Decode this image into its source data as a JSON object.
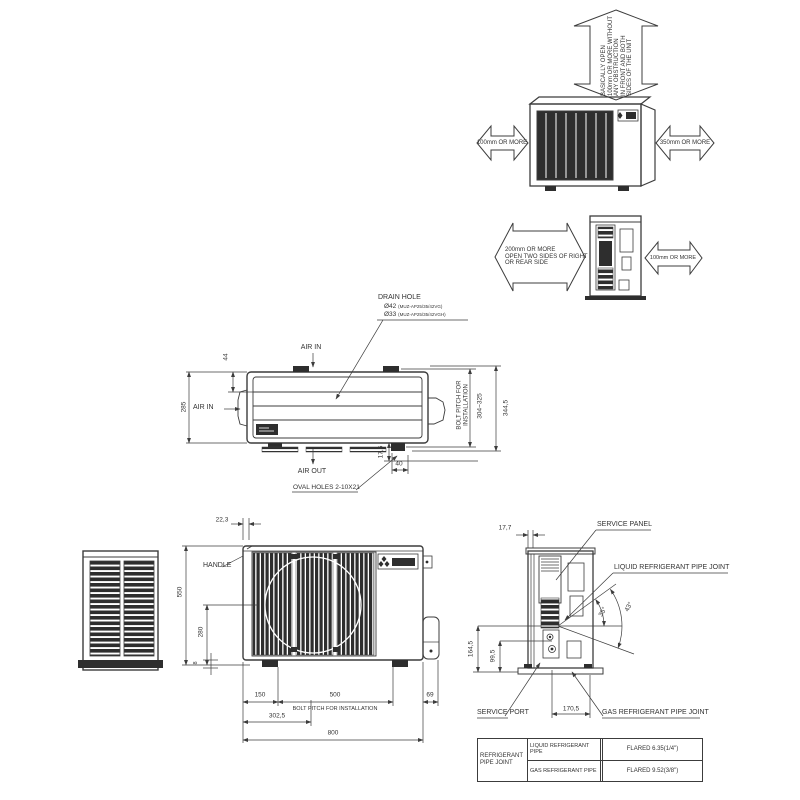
{
  "drawing_type": "outdoor-unit-dimension-drawing",
  "colors": {
    "line": "#3c3c3c",
    "dark_fill": "#2e2e2e",
    "text": "#333333",
    "background": "#ffffff"
  },
  "clearance_front": {
    "vertical_l1": "BASICALLY OPEN",
    "vertical_l2": "100mm OR MORE WITHOUT",
    "vertical_l3": "ANY OBSTRUCTION",
    "vertical_l4": "IN FRONT AND BOTH",
    "vertical_l5": "SIDES OF THE UNIT",
    "left_label": "100mm OR MORE",
    "right_label": "350mm OR MORE"
  },
  "clearance_side": {
    "left_l1": "200mm OR MORE",
    "left_l2": "OPEN TWO SIDES OF RIGHT",
    "left_l3": "OR REAR SIDE",
    "right_label": "100mm OR MORE"
  },
  "top_view": {
    "drain_hole_title": "DRAIN HOLE",
    "drain_d1": "Ø42",
    "drain_d1_model": "(MUZ-AP25/35/42VG)",
    "drain_d2": "Ø33",
    "drain_d2_model": "(MUZ-AP25/35/42VGH)",
    "air_in_top": "AIR IN",
    "air_in_left": "AIR IN",
    "air_out": "AIR OUT",
    "dim_44": "44",
    "dim_285": "285",
    "bolt_pitch_l1": "BOLT PITCH FOR",
    "bolt_pitch_l2": "INSTALLATION",
    "dim_304_325": "304~325",
    "dim_344_5": "344,5",
    "dim_17_5": "17,5",
    "dim_40": "40",
    "oval_holes": "OVAL HOLES 2-10X21"
  },
  "front_view": {
    "dim_22_3": "22,3",
    "handle": "HANDLE",
    "dim_550": "550",
    "dim_280": "280",
    "dim_8": "8",
    "dim_150": "150",
    "dim_500": "500",
    "bolt_pitch_note": "BOLT PITCH FOR INSTALLATION",
    "dim_69": "69",
    "dim_302_5": "302,5",
    "dim_800": "800"
  },
  "side_view": {
    "dim_17_7": "17,7",
    "service_panel": "SERVICE PANEL",
    "liquid_joint": "LIQUID REFRIGERANT PIPE JOINT",
    "angle_inner": "35°",
    "angle_outer": "43°",
    "dim_164_5": "164,5",
    "dim_99_5": "99,5",
    "service_port": "SERVICE PORT",
    "dim_170_5": "170,5",
    "gas_joint": "GAS REFRIGERANT PIPE JOINT"
  },
  "table": {
    "header_l1": "REFRIGERANT",
    "header_l2": "PIPE JOINT",
    "rows": [
      {
        "label": "LIQUID REFRIGERANT PIPE",
        "value": "FLARED 6.35(1/4\")"
      },
      {
        "label": "GAS REFRIGERANT PIPE",
        "value": "FLARED 9.52(3/8\")"
      }
    ]
  }
}
